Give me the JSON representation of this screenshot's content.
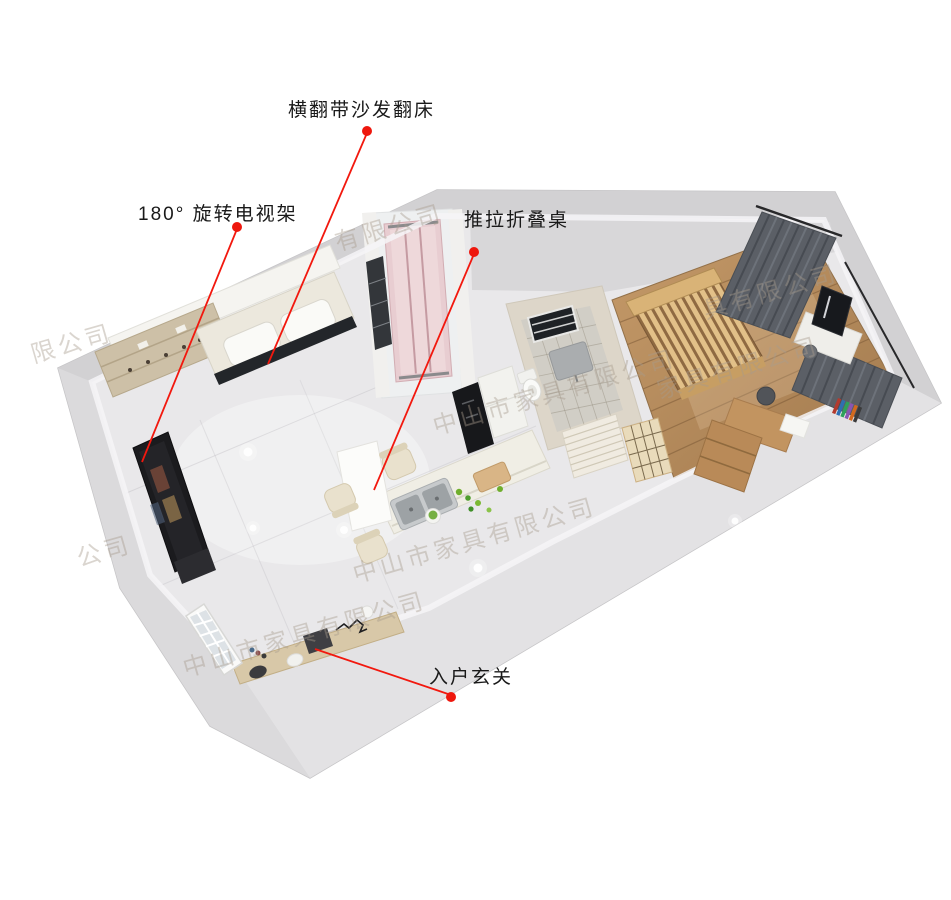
{
  "annotations": {
    "line_color": "#f2180e",
    "dot_color": "#ee170d",
    "items": [
      {
        "id": "flip-sofa-bed",
        "label": "横翻带沙发翻床"
      },
      {
        "id": "rotating-tv-mount",
        "label": "180° 旋转电视架"
      },
      {
        "id": "sliding-folding-table",
        "label": "推拉折叠桌"
      },
      {
        "id": "entry-foyer",
        "label": "入户玄关"
      }
    ]
  },
  "watermarks": {
    "items": [
      {
        "text": "有限公司"
      },
      {
        "text": "具有限公司"
      },
      {
        "text": "中山市家具有限公司"
      },
      {
        "text": "家具有限公司"
      },
      {
        "text": "中山市家具有限公司"
      },
      {
        "text": "中山市家具有限公司"
      },
      {
        "text": "公司"
      },
      {
        "text": "限公司"
      }
    ]
  }
}
